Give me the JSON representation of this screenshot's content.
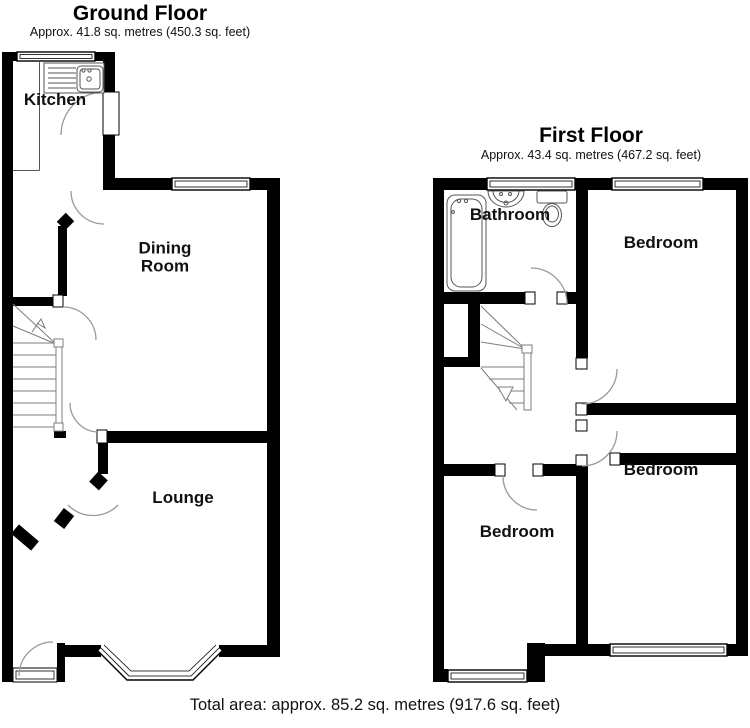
{
  "ground_floor": {
    "title": "Ground Floor",
    "subtitle": "Approx. 41.8 sq. metres (450.3 sq. feet)",
    "rooms": {
      "kitchen": "Kitchen",
      "dining_room": "Dining Room",
      "lounge": "Lounge"
    }
  },
  "first_floor": {
    "title": "First Floor",
    "subtitle": "Approx. 43.4 sq. metres (467.2 sq. feet)",
    "rooms": {
      "bathroom": "Bathroom",
      "bedroom_front": "Bedroom",
      "bedroom_rear": "Bedroom",
      "bedroom_left": "Bedroom"
    }
  },
  "footer": {
    "total_area": "Total area: approx. 85.2 sq. metres (917.6 sq. feet)"
  },
  "colors": {
    "wall": "#000000",
    "background": "#ffffff",
    "fixture_line": "#555555",
    "stair_line": "#7d7d7d",
    "door_arc": "#9a9a9a",
    "text": "#111111"
  }
}
